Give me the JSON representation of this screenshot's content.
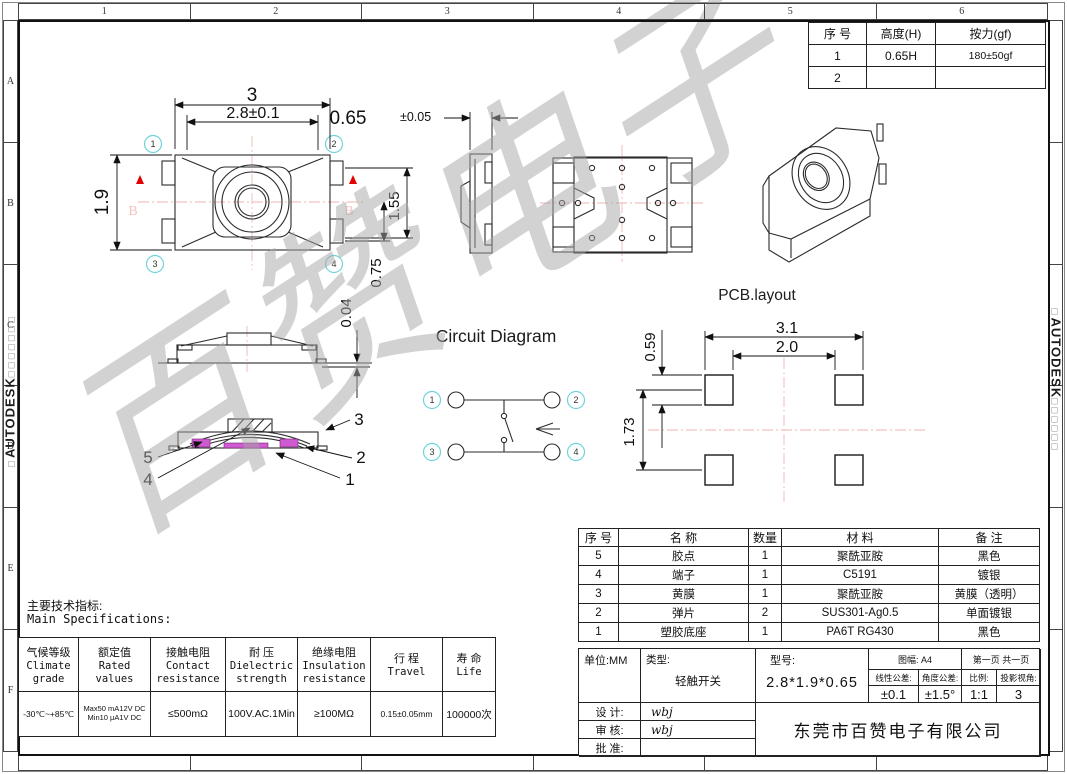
{
  "frame": {
    "brand": "AUTODESK",
    "stamp_prefix": "□",
    "stamp_boxes_left": "□□□□□□□",
    "stamp_boxes_right": "□□□□□□",
    "watermark": "百赞电子",
    "zone_cols": [
      "1",
      "2",
      "3",
      "4",
      "5",
      "6"
    ],
    "zone_rows": [
      "A",
      "B",
      "C",
      "D",
      "E",
      "F"
    ]
  },
  "pins": [
    "1",
    "2",
    "3",
    "4"
  ],
  "force_table": {
    "headers": [
      "序 号",
      "高度(H)",
      "按力(gf)"
    ],
    "rows": [
      [
        "1",
        "0.65H",
        "180±50gf"
      ],
      [
        "2",
        "",
        ""
      ]
    ]
  },
  "top_view": {
    "dim_total_width": "3",
    "dim_body_width": "2.8±0.1",
    "dim_height": "1.9",
    "dim_upper_right": "1.55",
    "dim_lower_right": "0.75",
    "section_label": "B"
  },
  "side_view": {
    "dim_thickness": "0.65",
    "dim_tolerance": "±0.05"
  },
  "profile_view": {
    "dim_gap": "0.04"
  },
  "section_view": {
    "labels": [
      "3",
      "2",
      "1",
      "5",
      "4"
    ]
  },
  "circuit": {
    "title": "Circuit Diagram"
  },
  "pcb": {
    "title": "PCB.layout",
    "dim_outer_width": "3.1",
    "dim_inner_width": "2.0",
    "dim_pad_height": "0.59",
    "dim_pitch": "1.73"
  },
  "specs": {
    "title_cn": "主要技术指标:",
    "title_en": "Main Specifications:",
    "columns": [
      {
        "cn": "气候等级",
        "en": "Climate\ngrade"
      },
      {
        "cn": "额定值",
        "en": "Rated\nvalues"
      },
      {
        "cn": "接触电阻",
        "en": "Contact\nresistance"
      },
      {
        "cn": "耐  压",
        "en": "Dielectric\nstrength"
      },
      {
        "cn": "绝缘电阻",
        "en": "Insulation\nresistance"
      },
      {
        "cn": "行 程",
        "en": "Travel"
      },
      {
        "cn": "寿 命",
        "en": "Life"
      }
    ],
    "values": [
      "-30℃~+85℃",
      "Max50 mA12V DC\nMin10 μA1V DC",
      "≤500mΩ",
      "100V.AC.1Min",
      "≥100MΩ",
      "0.15±0.05mm",
      "100000次"
    ]
  },
  "bom": {
    "headers": [
      "序 号",
      "名 称",
      "数量",
      "材 料",
      "备 注"
    ],
    "rows": [
      [
        "5",
        "胶点",
        "1",
        "聚酰亚胺",
        "黑色"
      ],
      [
        "4",
        "端子",
        "1",
        "C5191",
        "镀银"
      ],
      [
        "3",
        "黄膜",
        "1",
        "聚酰亚胺",
        "黄膜（透明）"
      ],
      [
        "2",
        "弹片",
        "2",
        "SUS301-Ag0.5",
        "单面镀银"
      ],
      [
        "1",
        "塑胶底座",
        "1",
        "PA6T RG430",
        "黑色"
      ]
    ]
  },
  "title_block": {
    "unit": "单位:MM",
    "type_label": "类型:",
    "type_value": "轻触开关",
    "model_label": "型号:",
    "model_value": "2.8*1.9*0.65",
    "sheet_label": "图幅: A4",
    "page_label": "第一页 共一页",
    "linear_tol_label": "线性公差:",
    "linear_tol_value": "±0.1",
    "angle_tol_label": "角度公差:",
    "angle_tol_value": "±1.5°",
    "scale_label": "比例:",
    "scale_value": "1:1",
    "view_label": "投影视角:",
    "view_value": "3",
    "design_label": "设  计:",
    "design_value": "wbj",
    "audit_label": "审  核:",
    "audit_value": "wbj",
    "approve_label": "批  准:",
    "approve_value": "",
    "company": "东莞市百赞电子有限公司"
  }
}
